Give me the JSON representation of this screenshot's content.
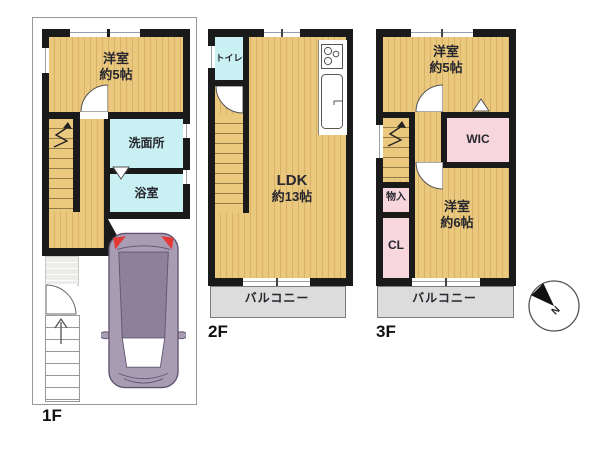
{
  "title": "floor-plan",
  "floor1": {
    "label": "1F",
    "room_west5": {
      "line1": "洋室",
      "line2": "約5帖"
    },
    "washroom": "洗面所",
    "bathroom": "浴室"
  },
  "floor2": {
    "label": "2F",
    "toilet": "トイレ",
    "ldk": {
      "line1": "LDK",
      "line2": "約13帖"
    },
    "balcony": "バルコニー"
  },
  "floor3": {
    "label": "3F",
    "room_west5": {
      "line1": "洋室",
      "line2": "約5帖"
    },
    "wic": "WIC",
    "storage": "物入",
    "closet": "CL",
    "room_west6": {
      "line1": "洋室",
      "line2": "約6帖"
    },
    "balcony": "バルコニー"
  },
  "compass": {
    "north_label": "N"
  },
  "colors": {
    "wall": "#1a1a1a",
    "floor": "#eac87e",
    "floor_stripe": "#d9b268",
    "water": "#c9f0f2",
    "closet": "#f8d6dd",
    "balcony": "#dcdcdc",
    "car_body": "#a89cb2",
    "car_roof": "#8e8099",
    "car_accent": "#e53935",
    "line": "#555555",
    "lot_line": "#999999",
    "text": "#26262e"
  }
}
